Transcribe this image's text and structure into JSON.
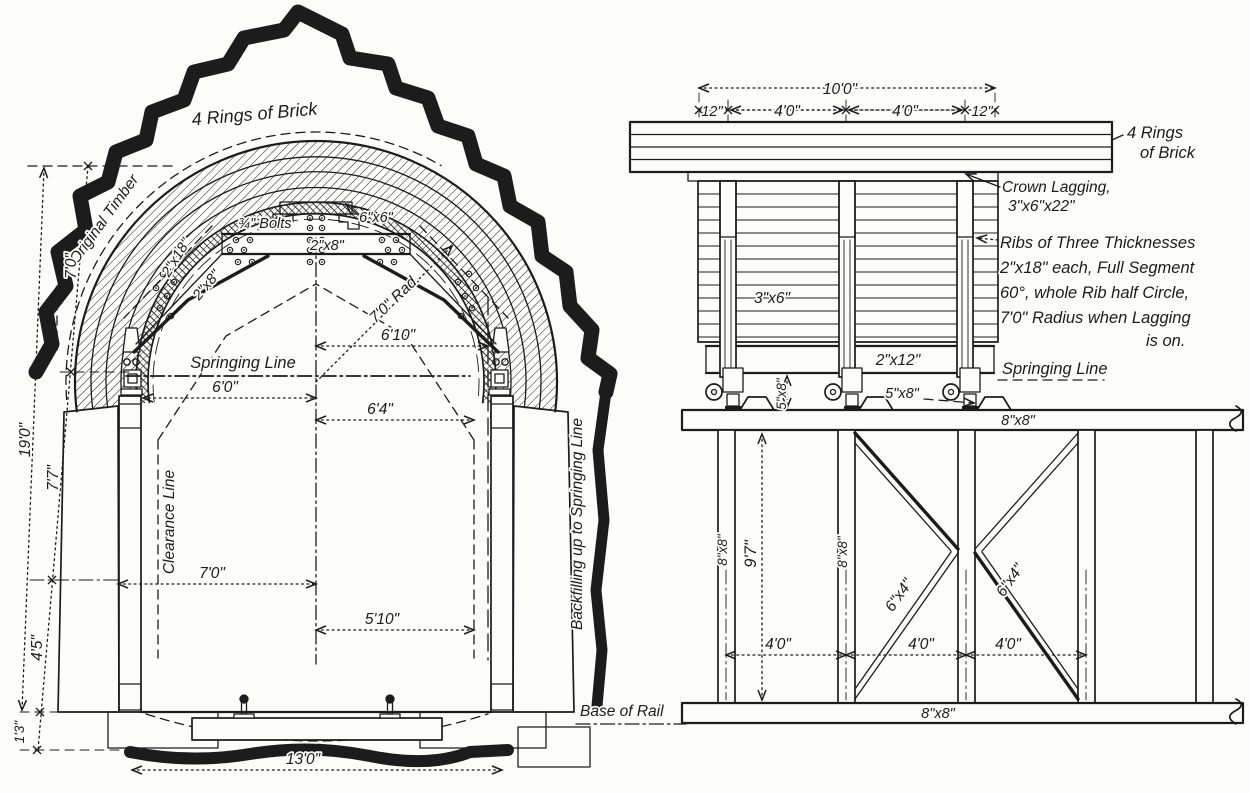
{
  "colors": {
    "ink": "#1c1c1c",
    "paper": "#fcfcf9"
  },
  "left_view": {
    "title": "4 Rings of Brick",
    "original_timber": "Original Timber",
    "bolts": "¾\" Bolts",
    "block_6x6": "6\"x6\"",
    "beam_2x8": "2\"x8\"",
    "diag_2x18": "2\"x18\"",
    "diag_2x8": "2\"x8\"",
    "radius": "7'0\" Rad.",
    "springing_line": "Springing Line",
    "clearance_line": "Clearance Line",
    "backfilling": "Backfilling up to Springing Line",
    "base_of_rail": "Base of Rail",
    "dim_6_10": "6'10\"",
    "dim_6_0": "6'0\"",
    "dim_6_4": "6'4\"",
    "dim_7_0_width": "7'0\"",
    "dim_5_10": "5'10\"",
    "dim_19_0": "19'0\"",
    "dim_7_0_height": "7'0\"",
    "dim_7_7": "7'7\"",
    "dim_4_5": "4'5\"",
    "dim_1_3": "1'3\"",
    "dim_13_0": "13'0\""
  },
  "right_view": {
    "title_line1": "4 Rings",
    "title_line2": "of Brick",
    "crown_lagging_line1": "Crown Lagging,",
    "crown_lagging_line2": "3\"x6\"x22\"",
    "ribs_note_line1": "Ribs of Three Thicknesses",
    "ribs_note_line2": "2\"x18\" each, Full Segment",
    "ribs_note_line3": "60°, whole Rib half Circle,",
    "ribs_note_line4": "7'0\" Radius when Lagging",
    "ribs_note_line5": "is on.",
    "lagging_3x6": "3\"x6\"",
    "plank_2x12": "2\"x12\"",
    "springing_line": "Springing Line",
    "wedge_5x8_dim": "5\"x8\"",
    "wedge_5x8": "5\"x8\"",
    "cap_8x8": "8\"x8\"",
    "post1_8x8": "8\"x8\"",
    "post2_8x8": "8\"x8\"",
    "brace1_6x4": "6\"x4\"",
    "brace2_6x4": "6\"x4\"",
    "sill_8x8": "8\"x8\"",
    "dim_10_0": "10'0\"",
    "dim_12_left": "12\"",
    "dim_4_0_left": "4'0\"",
    "dim_4_0_right": "4'0\"",
    "dim_12_right": "12\"",
    "dim_9_7": "9'7\"",
    "dim_4_0_p1": "4'0\"",
    "dim_4_0_p2": "4'0\"",
    "dim_4_0_p3": "4'0\""
  }
}
